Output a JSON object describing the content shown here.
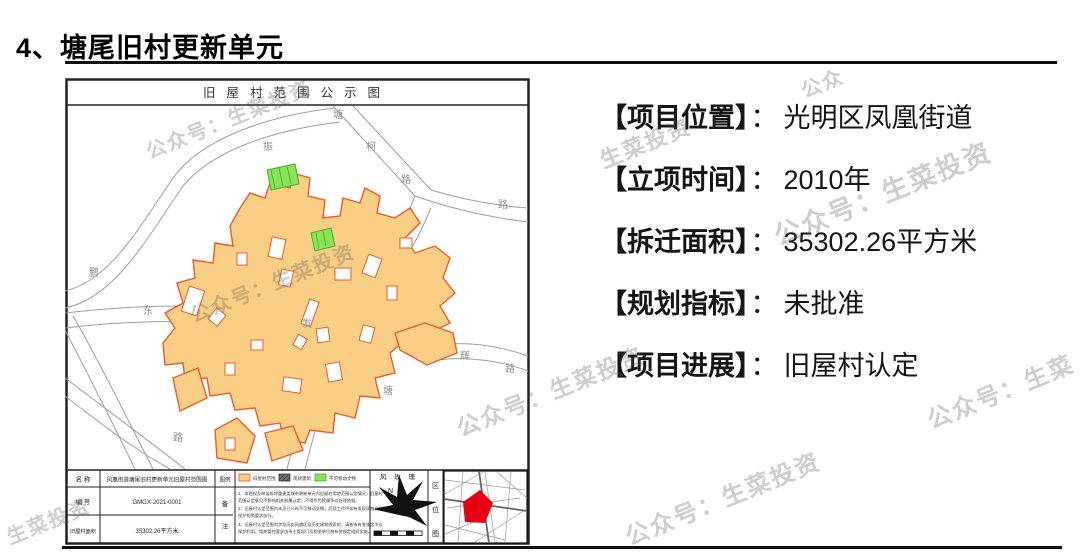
{
  "page": {
    "title": "4、塘尾旧村更新单元"
  },
  "info": {
    "colon": "：",
    "items": [
      {
        "label": "【项目位置】",
        "value": "光明区凤凰街道"
      },
      {
        "label": "【立项时间】",
        "value": "2010年"
      },
      {
        "label": "【拆迁面积】",
        "value": "35302.26平方米"
      },
      {
        "label": "【规划指标】",
        "value": "未批准"
      },
      {
        "label": "【项目进展】",
        "value": "旧屋村认定"
      }
    ]
  },
  "map": {
    "title": "旧屋村范围公示图",
    "road_labels": [
      "振",
      "塘",
      "柯",
      "路",
      "路",
      "东",
      "鹏",
      "发",
      "路",
      "塘",
      "辉",
      "路"
    ],
    "colors": {
      "area_fill": "#f8cf85",
      "area_stroke": "#ec5b2b",
      "green_fill": "#8ae257",
      "green_stroke": "#46ae27",
      "road": "#9aa0a0",
      "locator_red": "#e60014"
    },
    "table": {
      "name_label": "名  称",
      "name_value": "凤凰街道塘尾旧村更新单元旧屋村范围图",
      "code_label": "编  号",
      "code_value": "GMGX-2021-0001",
      "area_label": "旧屋村面积",
      "area_value": "35302.26平方米",
      "legend_label": "图例",
      "notes_label_1": "备",
      "notes_label_2": "注",
      "windrose_label": "风 玫 瑰",
      "north_label": "N",
      "location_label_1": "区",
      "location_label_2": "位",
      "location_label_3": "图",
      "legend_items": [
        {
          "label": "旧屋村范围"
        },
        {
          "label": "现状建筑"
        },
        {
          "label": "不可移动文物"
        }
      ],
      "notes_lines": [
        "1、本图仅反映该拆除重建类城市更新单元内旧屋村用地范围认定情况，旧屋村",
        "范围认定意见不影响相关权属认定，不得作为权属争议处理依据。",
        "2、旧屋村认定范围内未见已公布不可移动文物，后续工作中如有发现须按文物",
        "保护相关要求执行。",
        "3、旧屋村认定范围内涉及历史风貌区及历史建筑线索的，请按市有关规定予以",
        "保护利用，相关管控要求由市主管部门及相关单位按有关规定组织实施。"
      ]
    }
  },
  "watermarks": [
    {
      "text": "公众号：生菜投资"
    },
    {
      "text": "公众号：生菜投资"
    },
    {
      "text": "公众号：生菜投资"
    },
    {
      "text": "生菜投资"
    },
    {
      "text": "公众号：生菜投资"
    },
    {
      "text": "公众"
    },
    {
      "text": "公众号：生菜"
    },
    {
      "text": "公众号：生菜投资"
    },
    {
      "text": "生菜投资"
    }
  ]
}
